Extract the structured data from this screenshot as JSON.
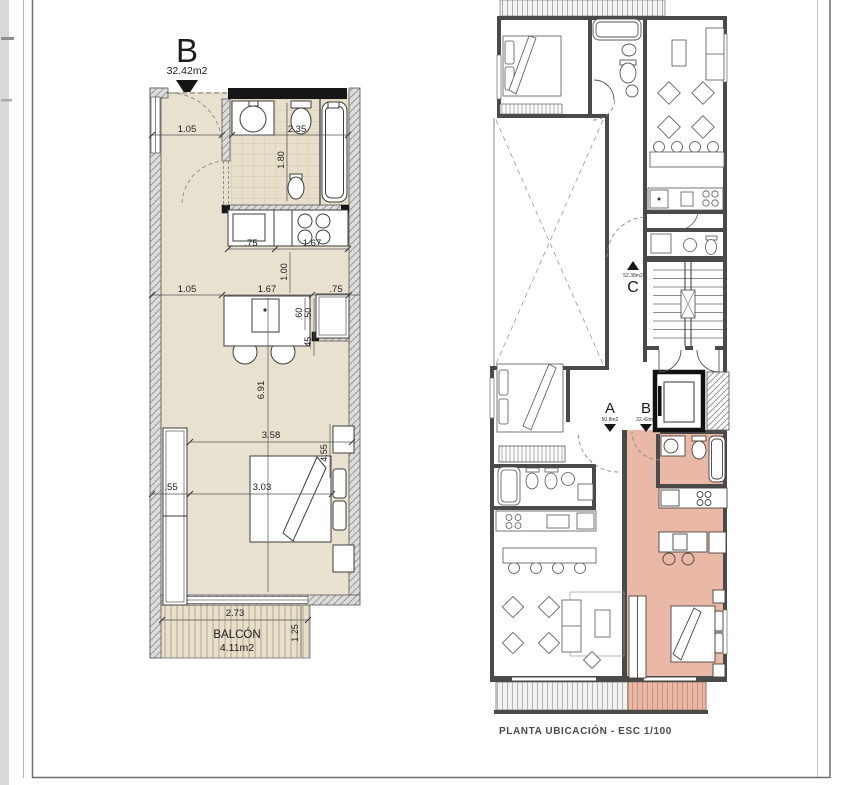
{
  "detail_plan": {
    "unit_label": "B",
    "unit_area": "32.42m2",
    "balcony": {
      "label": "BALCÓN",
      "area": "4.11m2"
    },
    "dims": {
      "entry_width": "1.05",
      "bath_width": "2.35",
      "bath_depth": "1.80",
      "counter_left": ".75",
      "counter_right": "1.67",
      "kitchen_depth": "1.00",
      "hall_left": "1.05",
      "hall_mid": "1.67",
      "hall_right": ".75",
      "island_top": ".60",
      "island_mid": ".50",
      "island_bottom": ".45",
      "room_length": "6.91",
      "room_width_upper": "3.58",
      "room_width_lower": "3.03",
      "closet_depth": ".55",
      "bed_side": "4.55",
      "balcony_width": "2.73",
      "balcony_depth": "1.25"
    }
  },
  "location_plan": {
    "caption": "PLANTA UBICACIÓN - ESC 1/100",
    "units": [
      {
        "label": "A",
        "area": "50.8m2"
      },
      {
        "label": "B",
        "area": "32.42m2"
      },
      {
        "label": "C",
        "area": "52.38m2"
      }
    ]
  },
  "colors": {
    "highlight_unit": "#e9b8a7",
    "floor_beige": "#e9e1d0",
    "wall_gray": "#4a4a4a"
  }
}
